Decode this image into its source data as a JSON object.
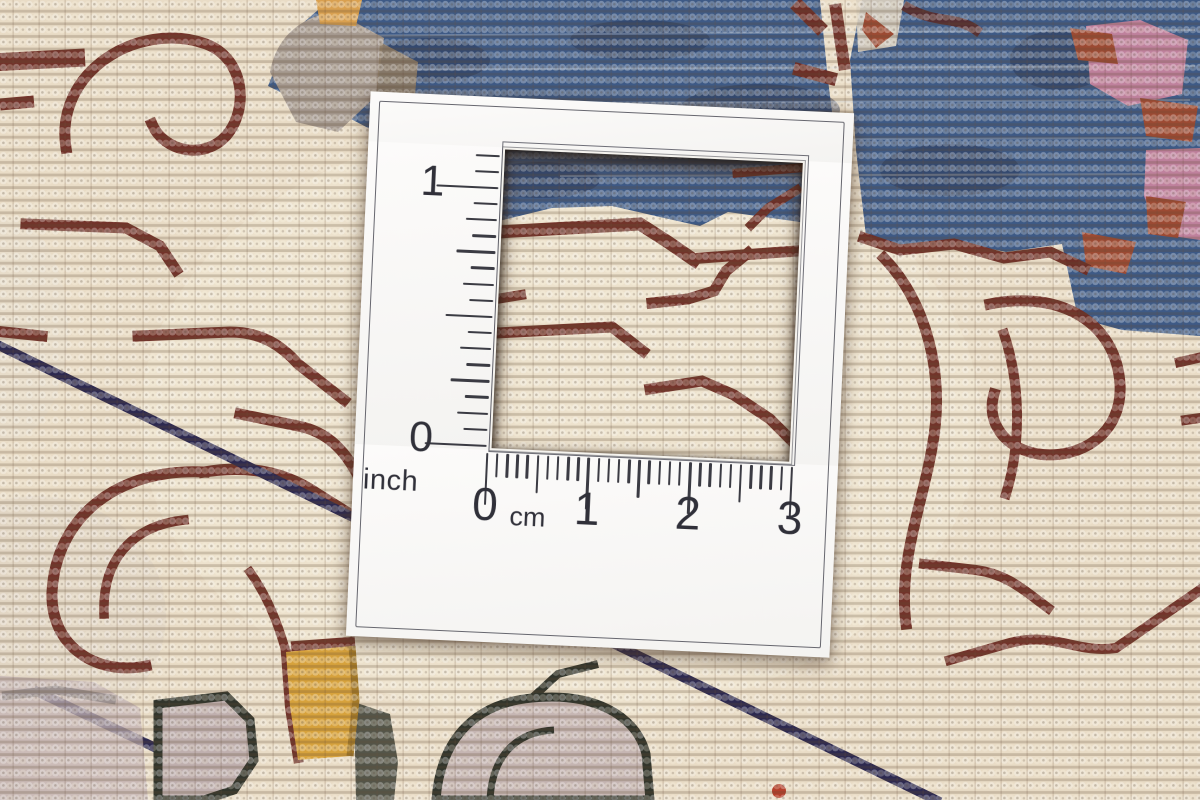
{
  "photo": {
    "description": "Close-up photograph of the knotted reverse side of an oriental carpet with a white knot-density measuring card laid on top; a square cutout window frames the knots",
    "palette": {
      "cream_field": "#e9dcc6",
      "maroon_motif": "#6e2d24",
      "blue_field": "#3e5a86",
      "navy_line": "#2d2950",
      "gray_patch": "#a69a90",
      "orange_patch": "#d9a050",
      "pink_patch": "#c6849e",
      "rust_patch": "#9c4a33",
      "yellow_patch": "#d7a23c",
      "lavender_patch": "#c2b1b3",
      "dark_outline": "#32352c",
      "card_white": "#fbfaf9",
      "ruler_ink": "#3b3b43"
    }
  },
  "card": {
    "inch_ruler": {
      "unit_label": "inch",
      "top_label": "1",
      "bottom_label": "0",
      "span_inches": 1,
      "divisions_per_inch": 16
    },
    "cm_ruler": {
      "unit_label": "cm",
      "labels": [
        "0",
        "1",
        "2",
        "3"
      ],
      "span_cm": 3,
      "divisions_per_cm": 10
    }
  }
}
